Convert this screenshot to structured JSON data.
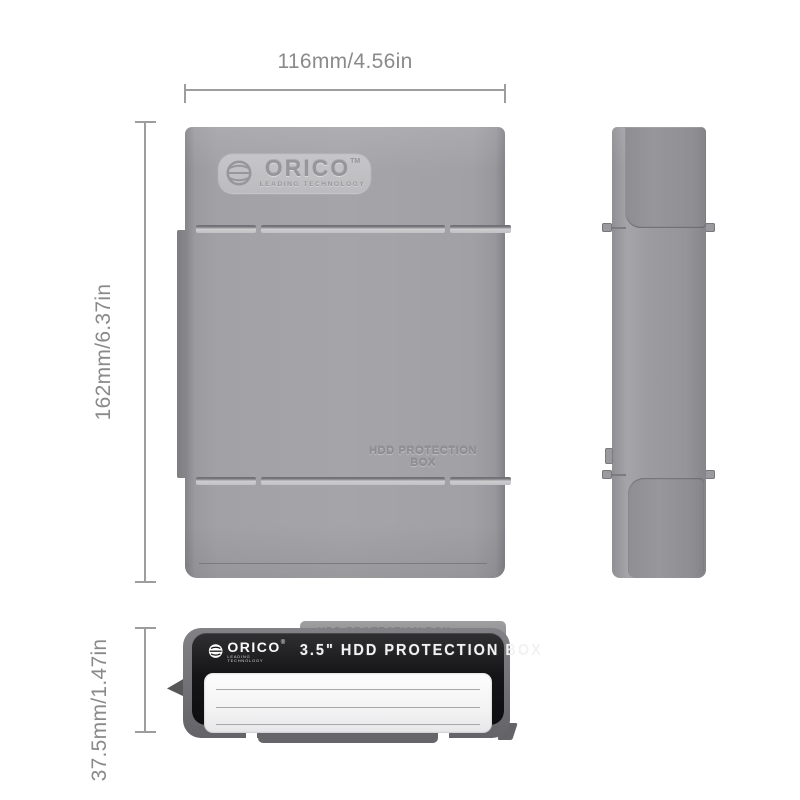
{
  "page": {
    "background": "#ffffff",
    "type": "product-dimension-diagram"
  },
  "dimensions": {
    "width_label": "116mm/4.56in",
    "height_label": "162mm/6.37in",
    "thickness_label": "37.5mm/1.47in"
  },
  "front_view": {
    "logo": {
      "brand": "ORICO",
      "trademark": "TM",
      "tagline": "LEADING TECHNOLOGY"
    },
    "embossed_text": "HDD PROTECTION BOX"
  },
  "bottom_view": {
    "rear_embossed_text": "HDD PROTECTION BOX",
    "label": {
      "brand": "ORICO",
      "registered": "®",
      "tagline": "LEADING TECHNOLOGY",
      "title": "3.5\" HDD PROTECTION BOX"
    }
  },
  "colors": {
    "body_gray": "#9a9a9e",
    "edge_gray": "#85858a",
    "plate_gray": "#c2c2c5",
    "label_black": "#161618",
    "panel_white": "#f2f2f4",
    "dimension_gray": "#8a8a8a"
  }
}
